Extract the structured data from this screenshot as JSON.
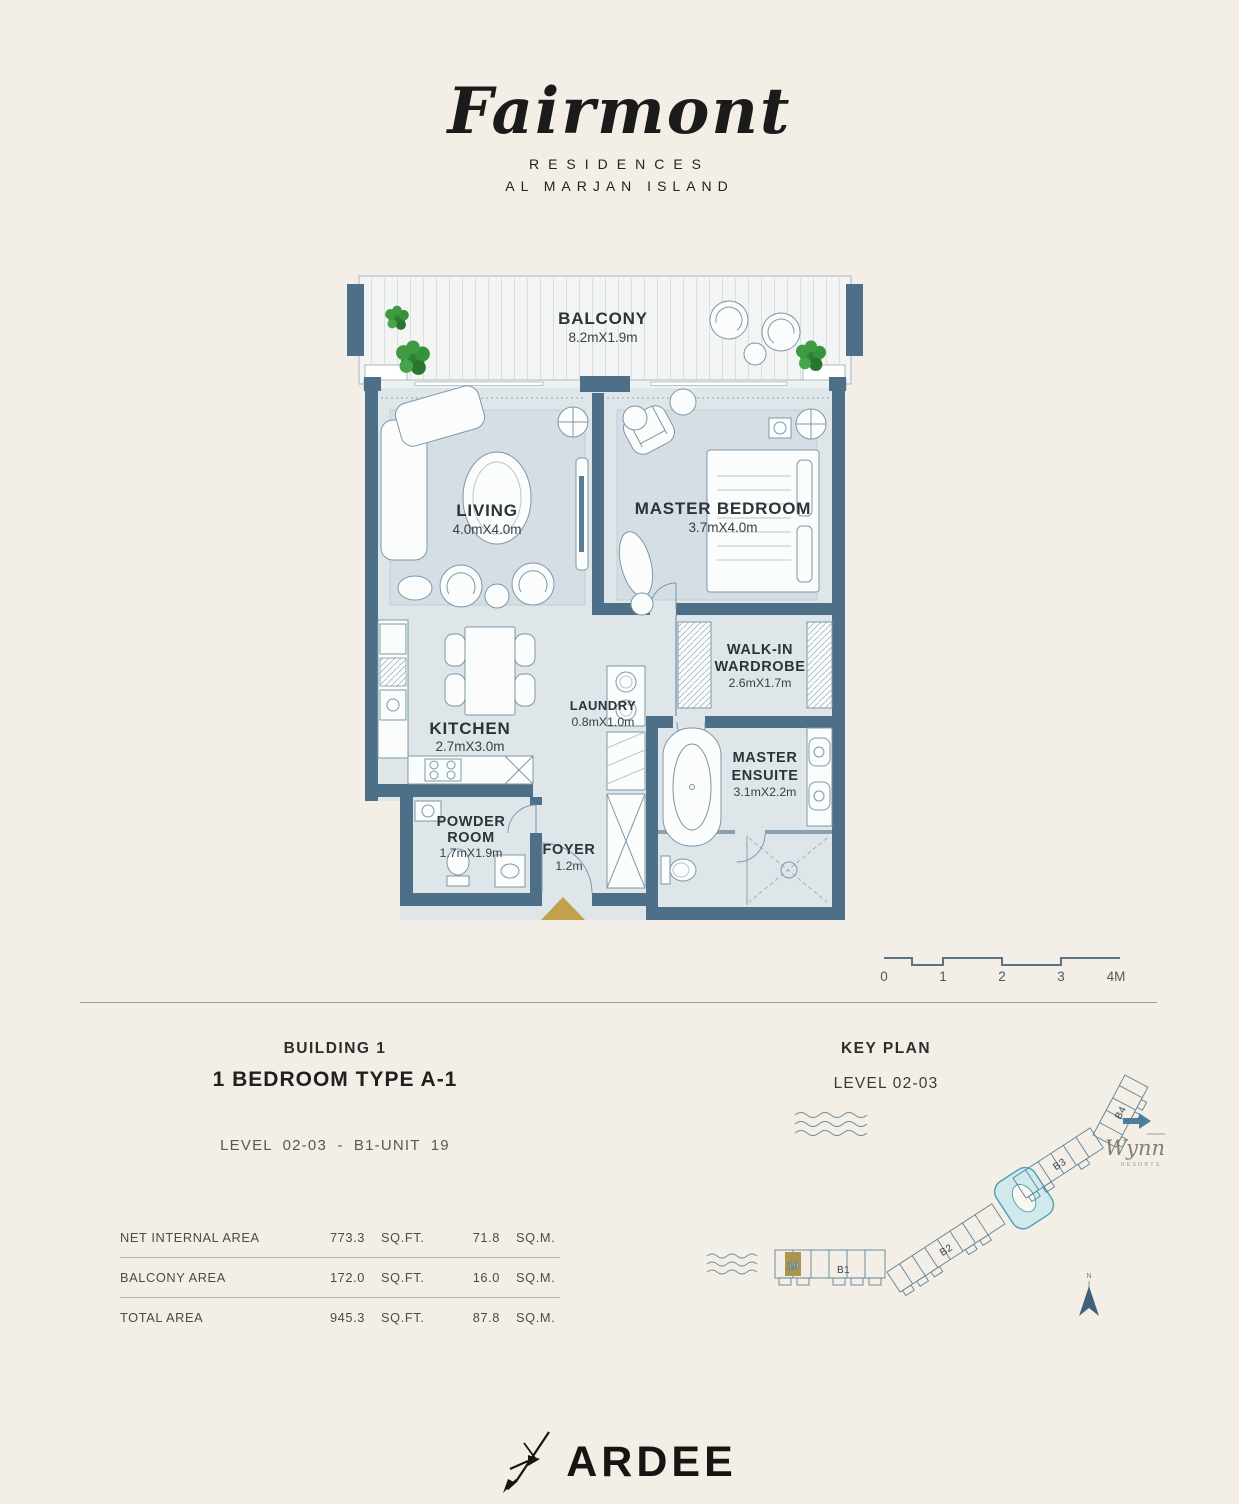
{
  "brand": {
    "script": "Fairmont",
    "residences": "RESIDENCES",
    "island": "AL MARJAN ISLAND"
  },
  "plan": {
    "rooms": {
      "balcony": {
        "name": "BALCONY",
        "dims": "8.2mX1.9m"
      },
      "living": {
        "name": "LIVING",
        "dims": "4.0mX4.0m"
      },
      "master_bedroom": {
        "name": "MASTER BEDROOM",
        "dims": "3.7mX4.0m"
      },
      "wardrobe": {
        "name": "WALK-IN",
        "name2": "WARDROBE",
        "dims": "2.6mX1.7m"
      },
      "kitchen": {
        "name": "KITCHEN",
        "dims": "2.7mX3.0m"
      },
      "laundry": {
        "name": "LAUNDRY",
        "dims": "0.8mX1.0m"
      },
      "ensuite": {
        "name": "MASTER",
        "name2": "ENSUITE",
        "dims": "3.1mX2.2m"
      },
      "powder": {
        "name": "POWDER",
        "name2": "ROOM",
        "dims": "1.7mX1.9m"
      },
      "foyer": {
        "name": "FOYER",
        "dims": "1.2m"
      }
    }
  },
  "scale_bar": {
    "labels": [
      "0",
      "1",
      "2",
      "3",
      "4M"
    ]
  },
  "unit_info": {
    "building": "BUILDING 1",
    "unit_type": "1 BEDROOM TYPE A-1",
    "level_line": "LEVEL 02-03 - B1-UNIT 19"
  },
  "key_plan": {
    "title": "KEY PLAN",
    "level": "LEVEL 02-03",
    "buildings": [
      "B1",
      "B2",
      "B3",
      "B4"
    ],
    "highlight_unit": "19",
    "compass": "N",
    "partner": {
      "name": "Wynn",
      "sub": "RESORTS"
    }
  },
  "areas": {
    "rows": [
      {
        "label": "NET INTERNAL AREA",
        "sqft": "773.3",
        "sqft_unit": "SQ.FT.",
        "sqm": "71.8",
        "sqm_unit": "SQ.M."
      },
      {
        "label": "BALCONY AREA",
        "sqft": "172.0",
        "sqft_unit": "SQ.FT.",
        "sqm": "16.0",
        "sqm_unit": "SQ.M."
      },
      {
        "label": "TOTAL AREA",
        "sqft": "945.3",
        "sqft_unit": "SQ.FT.",
        "sqm": "87.8",
        "sqm_unit": "SQ.M."
      }
    ]
  },
  "footer": {
    "brand": "ARDEE"
  },
  "colors": {
    "wall": "#4e6f88",
    "floor": "#dee6ea",
    "accent_gold": "#c2a14d",
    "keyplan_highlight": "#cfe9ec",
    "background": "#f4efe6"
  }
}
